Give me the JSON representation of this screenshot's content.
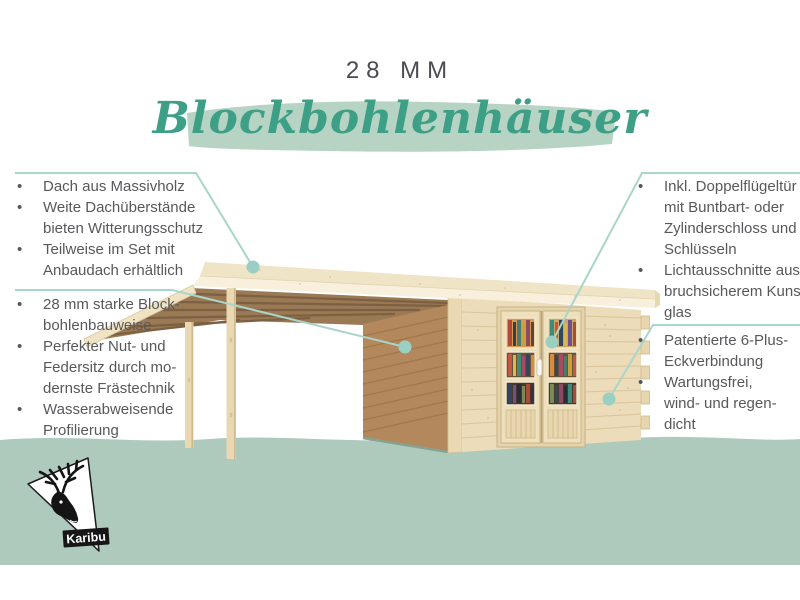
{
  "header": {
    "thickness_label": "28 MM",
    "title": "Blockbohlenhäuser"
  },
  "callouts": {
    "left_top": {
      "items": [
        {
          "lines": [
            "Dach aus Massivholz"
          ]
        },
        {
          "lines": [
            "Weite Dachüberstände",
            "bieten Witterungsschutz"
          ]
        },
        {
          "lines": [
            "Teilweise im Set mit",
            "Anbaudach erhältlich"
          ]
        }
      ]
    },
    "left_bottom": {
      "items": [
        {
          "lines": [
            "28 mm starke Block-",
            "bohlenbauweise"
          ]
        },
        {
          "lines": [
            "Perfekter Nut- und",
            "Federsitz durch mo-",
            "dernste Frästechnik"
          ]
        },
        {
          "lines": [
            "Wasserabweisende",
            "Profilierung"
          ]
        }
      ]
    },
    "right_top": {
      "items": [
        {
          "lines": [
            "Inkl. Doppelflügeltür",
            "mit Buntbart- oder",
            "Zylinderschloss und",
            "Schlüsseln"
          ]
        },
        {
          "lines": [
            "Lichtausschnitte aus",
            "bruchsicherem Kunst-",
            "glas"
          ]
        }
      ]
    },
    "right_bottom": {
      "items": [
        {
          "lines": [
            "Patentierte 6-Plus-",
            "Eckverbindung"
          ]
        },
        {
          "lines": [
            "Wartungsfrei,",
            "wind- und regen-",
            "dicht"
          ]
        }
      ]
    }
  },
  "logo": {
    "brand": "Karibu"
  },
  "ui": {
    "bullet_char": "•"
  },
  "colors": {
    "title_green": "#3da086",
    "brush_sage": "#b7d3c3",
    "ground_sage": "#aecabd",
    "accent_teal": "#a9d5ca",
    "dot_teal": "#9bcfc3",
    "text_gray": "#57585b",
    "label_dark": "#4b4b52",
    "roof_cream": "#f1e6c8",
    "wall_light": "#ecdcba",
    "wall_shadow": "#b3885c",
    "rafter_brown": "#9a7a54"
  }
}
